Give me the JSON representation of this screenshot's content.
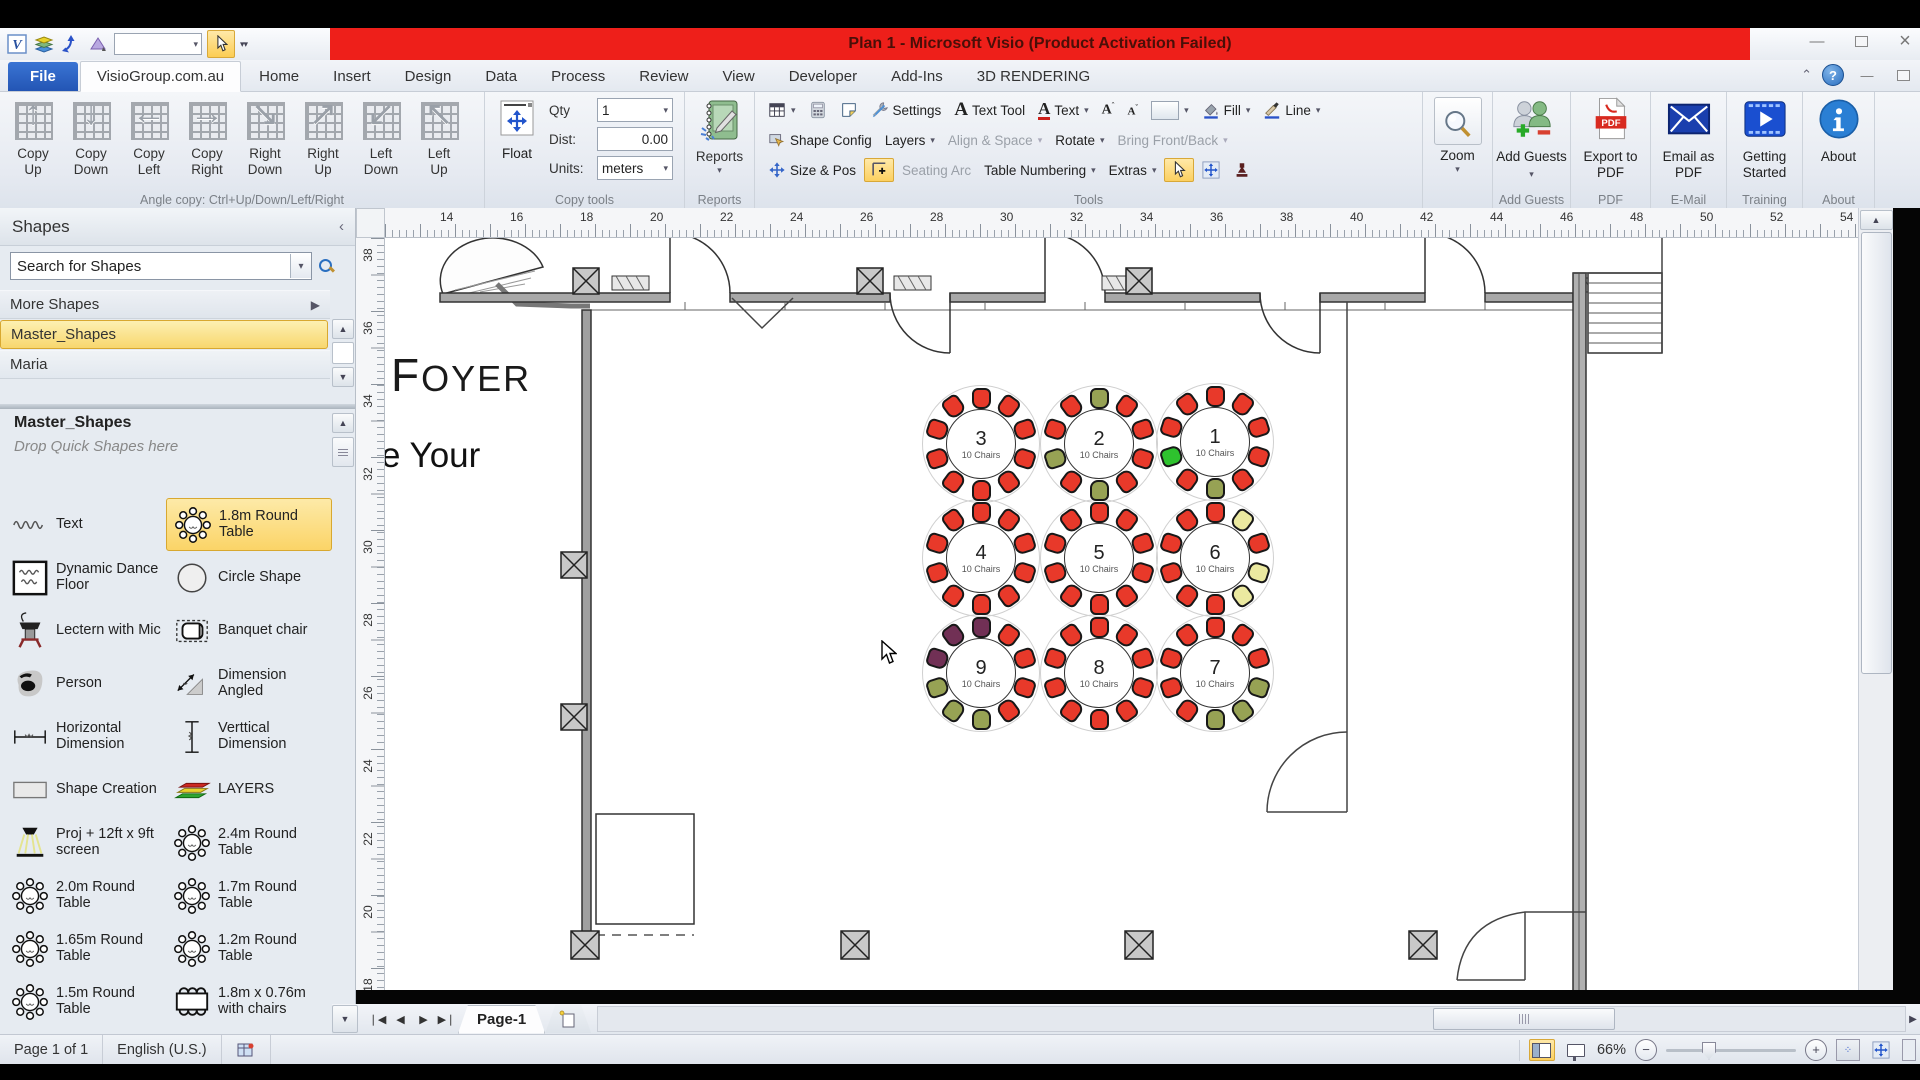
{
  "window": {
    "title": "Plan 1 - Microsoft Visio (Product Activation Failed)"
  },
  "tabs": {
    "items": [
      "File",
      "VisioGroup.com.au",
      "Home",
      "Insert",
      "Design",
      "Data",
      "Process",
      "Review",
      "View",
      "Developer",
      "Add-Ins",
      "3D RENDERING"
    ],
    "active": "VisioGroup.com.au"
  },
  "ribbon": {
    "angle_copy": {
      "label": "Angle copy: Ctrl+Up/Down/Left/Right",
      "buttons": [
        {
          "label": "Copy Up",
          "arrow": "↑"
        },
        {
          "label": "Copy Down",
          "arrow": "↓"
        },
        {
          "label": "Copy Left",
          "arrow": "←"
        },
        {
          "label": "Copy Right",
          "arrow": "→"
        },
        {
          "label": "Right Down",
          "arrow": "↘"
        },
        {
          "label": "Right Up",
          "arrow": "↗"
        },
        {
          "label": "Left Down",
          "arrow": "↙"
        },
        {
          "label": "Left Up",
          "arrow": "↖"
        }
      ]
    },
    "copy_tools": {
      "label": "Copy tools",
      "float_label": "Float",
      "qty_label": "Qty",
      "qty_value": "1",
      "dist_label": "Dist:",
      "dist_value": "0.00",
      "units_label": "Units:",
      "units_value": "meters"
    },
    "reports": {
      "label": "Reports",
      "button": "Reports"
    },
    "tools": {
      "label": "Tools",
      "settings": "Settings",
      "text_tool": "Text Tool",
      "text": "Text",
      "fill": "Fill",
      "line": "Line",
      "shape_config": "Shape Config",
      "layers": "Layers",
      "align_space": "Align & Space",
      "rotate": "Rotate",
      "bring_front": "Bring Front/Back",
      "size_pos": "Size & Pos",
      "seating_arc": "Seating Arc",
      "table_numbering": "Table Numbering",
      "extras": "Extras"
    },
    "zoom": {
      "button": "Zoom"
    },
    "add_guests": {
      "label": "Add Guests",
      "button": "Add Guests"
    },
    "pdf": {
      "label": "PDF",
      "button": "Export to PDF"
    },
    "email": {
      "label": "E-Mail",
      "button": "Email as PDF"
    },
    "training": {
      "label": "Training",
      "button": "Getting Started"
    },
    "about": {
      "label": "About",
      "button": "About"
    }
  },
  "shapes_panel": {
    "title": "Shapes",
    "search_text": "Search for Shapes",
    "more_shapes": "More Shapes",
    "stencils": [
      "Master_Shapes",
      "Maria"
    ],
    "active_stencil": "Master_Shapes",
    "stencil_header": "Master_Shapes",
    "drop_hint": "Drop Quick Shapes here",
    "items": [
      {
        "icon": "squiggle-icon",
        "label": "Text"
      },
      {
        "icon": "round-table-icon",
        "label": "1.8m Round Table",
        "selected": true
      },
      {
        "icon": "dance-floor-icon",
        "label": "Dynamic Dance Floor"
      },
      {
        "icon": "circle-shape-icon",
        "label": "Circle Shape"
      },
      {
        "icon": "lectern-icon",
        "label": "Lectern with Mic"
      },
      {
        "icon": "banquet-chair-icon",
        "label": "Banquet chair"
      },
      {
        "icon": "person-icon",
        "label": "Person"
      },
      {
        "icon": "dim-angled-icon",
        "label": "Dimension Angled"
      },
      {
        "icon": "h-dim-icon",
        "label": "Horizontal Dimension"
      },
      {
        "icon": "v-dim-icon",
        "label": "Verttical Dimension"
      },
      {
        "icon": "shape-creation-icon",
        "label": "Shape Creation"
      },
      {
        "icon": "layers-icon",
        "label": "LAYERS"
      },
      {
        "icon": "projector-icon",
        "label": "Proj + 12ft x 9ft screen"
      },
      {
        "icon": "round-table-icon",
        "label": "2.4m Round Table"
      },
      {
        "icon": "round-table-icon",
        "label": "2.0m Round Table"
      },
      {
        "icon": "round-table-icon",
        "label": "1.7m Round Table"
      },
      {
        "icon": "round-table-icon",
        "label": "1.65m Round Table"
      },
      {
        "icon": "round-table-icon",
        "label": "1.2m Round Table"
      },
      {
        "icon": "round-table-icon",
        "label": "1.5m Round Table"
      },
      {
        "icon": "table-chairs-icon",
        "label": "1.8m x 0.76m with chairs"
      }
    ]
  },
  "canvas": {
    "h_ruler": [
      14,
      16,
      18,
      20,
      22,
      24,
      26,
      28,
      30,
      32,
      34,
      36,
      38,
      40,
      42,
      44,
      46,
      48,
      50,
      52,
      54
    ],
    "v_ruler": [
      38,
      36,
      34,
      32,
      30,
      28,
      26,
      24,
      22,
      20,
      18
    ],
    "foyer_text": "FOYER",
    "partial_text": "e Your",
    "tables": [
      {
        "number": "3",
        "seats_label": "10 Chairs",
        "x": 595,
        "y": 205,
        "chairs": [
          "red",
          "red",
          "red",
          "red",
          "red",
          "red",
          "red",
          "red",
          "red",
          "red"
        ]
      },
      {
        "number": "2",
        "seats_label": "10 Chairs",
        "x": 713,
        "y": 205,
        "chairs": [
          "olive",
          "red",
          "red",
          "red",
          "red",
          "olive",
          "red",
          "olive",
          "red",
          "red"
        ]
      },
      {
        "number": "1",
        "seats_label": "10 Chairs",
        "x": 829,
        "y": 203,
        "chairs": [
          "red",
          "red",
          "red",
          "red",
          "red",
          "olive",
          "red",
          "green",
          "red",
          "red"
        ]
      },
      {
        "number": "4",
        "seats_label": "10 Chairs",
        "x": 595,
        "y": 319,
        "chairs": [
          "red",
          "red",
          "red",
          "red",
          "red",
          "red",
          "red",
          "red",
          "red",
          "red"
        ]
      },
      {
        "number": "5",
        "seats_label": "10 Chairs",
        "x": 713,
        "y": 319,
        "chairs": [
          "red",
          "red",
          "red",
          "red",
          "red",
          "red",
          "red",
          "red",
          "red",
          "red"
        ]
      },
      {
        "number": "6",
        "seats_label": "10 Chairs",
        "x": 829,
        "y": 319,
        "chairs": [
          "red",
          "yellow",
          "red",
          "yellow",
          "yellow",
          "red",
          "red",
          "red",
          "red",
          "red"
        ]
      },
      {
        "number": "9",
        "seats_label": "10 Chairs",
        "x": 595,
        "y": 434,
        "chairs": [
          "purple",
          "red",
          "red",
          "red",
          "red",
          "olive",
          "olive",
          "olive",
          "purple",
          "purple"
        ]
      },
      {
        "number": "8",
        "seats_label": "10 Chairs",
        "x": 713,
        "y": 434,
        "chairs": [
          "red",
          "red",
          "red",
          "red",
          "red",
          "red",
          "red",
          "red",
          "red",
          "red"
        ]
      },
      {
        "number": "7",
        "seats_label": "10 Chairs",
        "x": 829,
        "y": 434,
        "chairs": [
          "red",
          "red",
          "red",
          "olive",
          "olive",
          "olive",
          "red",
          "red",
          "red",
          "red"
        ]
      }
    ]
  },
  "pages": {
    "page_tab": "Page-1"
  },
  "status": {
    "page_info": "Page 1 of 1",
    "language": "English (U.S.)",
    "zoom_percent": "66%"
  },
  "colors": {
    "title_red": "#ee1f1a",
    "highlight_yellow": "#fbd467",
    "chairs": {
      "red": "#e8392a",
      "olive": "#97a254",
      "yellow": "#ebe9a0",
      "green": "#2ec22e",
      "purple": "#713055"
    }
  }
}
